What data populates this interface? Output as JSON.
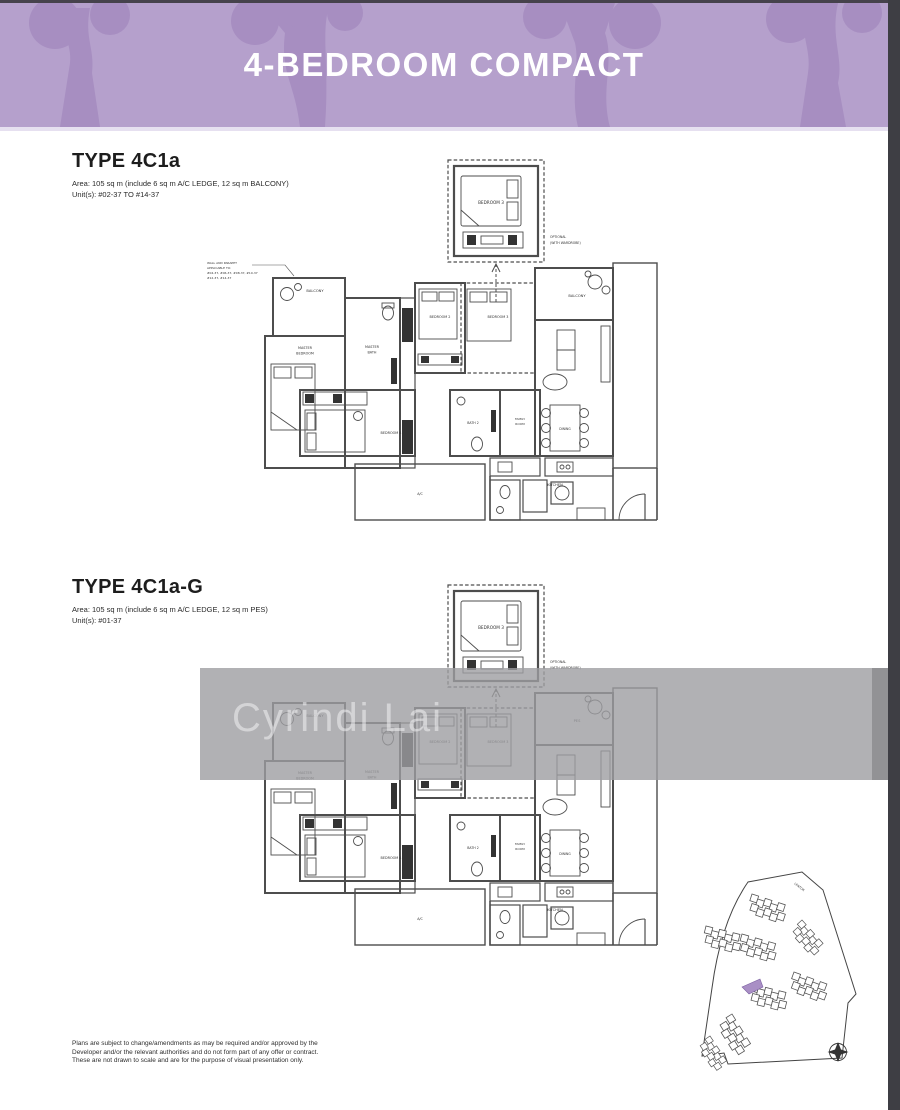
{
  "header": {
    "title": "4-BEDROOM COMPACT"
  },
  "plans": [
    {
      "title": "TYPE 4C1a",
      "area_line": "Area: 105 sq m (include 6 sq m A/C LEDGE, 12 sq m BALCONY)",
      "units_line": "Unit(s): #02-37 TO #14-37",
      "outdoor_label": "BALCONY",
      "wall_note": [
        "WALL AND PARAPET",
        "APPLICABLE TO:",
        "#04-37, #06-37, #08-37, #10-37",
        "#12-37, #14-37"
      ]
    },
    {
      "title": "TYPE 4C1a-G",
      "area_line": "Area: 105 sq m (include 6 sq m A/C LEDGE, 12 sq m PES)",
      "units_line": "Unit(s): #01-37",
      "outdoor_label": "PES"
    }
  ],
  "rooms": {
    "optional_bedroom": "BEDROOM 3",
    "optional_note": [
      "OPTIONAL",
      "(WITH WARDROBE)"
    ],
    "balcony": "BALCONY",
    "master_bedroom": [
      "MASTER",
      "BEDROOM"
    ],
    "master_bath": [
      "MASTER",
      "BATH"
    ],
    "bedroom2": "BEDROOM 2",
    "bedroom3": "BEDROOM 3",
    "bedroom4": "BEDROOM 4",
    "bath2": "BATH 2",
    "family_room": [
      "FAMILY",
      "ROOM"
    ],
    "dining": "DINING",
    "kitchen": "KITCHEN",
    "ac": "A/C"
  },
  "watermark": {
    "text": "Cyrindi Lai"
  },
  "site_plan": {
    "road_label": "LENTOR"
  },
  "disclaimer": [
    "Plans are subject to change/amendments as may be required and/or approved by the",
    "Developer and/or the relevant authorities and do not form part of any offer or contract.",
    "These are not drawn to scale and are for the purpose of visual presentation only."
  ],
  "colors": {
    "header_bg": "#b5a0cc",
    "header_pattern": "#a78ec1",
    "highlight": "#a98fc5",
    "frame": "#3e3e44"
  }
}
